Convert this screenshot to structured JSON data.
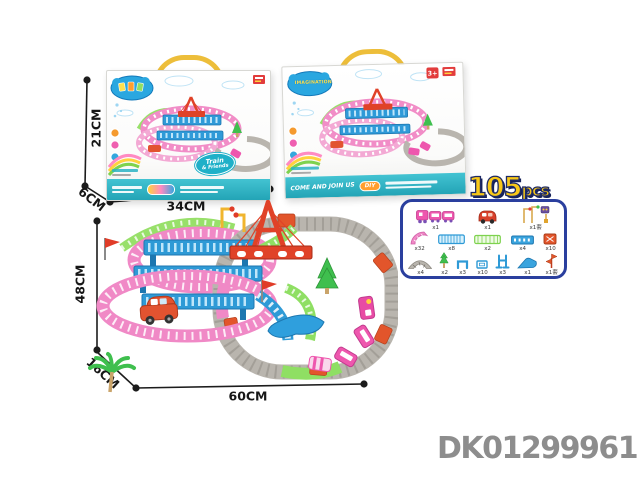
{
  "product": {
    "code": "DK01299961"
  },
  "pieces": {
    "count": "105",
    "unit": "pcs"
  },
  "dims": {
    "box_height": "21CM",
    "box_depth": "6CM",
    "box_width": "34CM",
    "set_height": "48CM",
    "set_depth": "16CM",
    "set_width": "60CM"
  },
  "box_front": {
    "badge_line1": "Train",
    "badge_line2": "& Friends"
  },
  "box_angled": {
    "logo": "IMAGINATION",
    "slogan": "COME AND JOIN US",
    "diy_label": "DIY",
    "age_label": "3+"
  },
  "parts": {
    "rows": [
      [
        {
          "name": "toy train",
          "qty": "x1"
        },
        {
          "name": "toy car",
          "qty": "x1"
        },
        {
          "name": "traffic signs set",
          "qty": "x1套"
        }
      ],
      [
        {
          "name": "pink curved track",
          "qty": "x32"
        },
        {
          "name": "blue bridge rail",
          "qty": "x8"
        },
        {
          "name": "green fence rail",
          "qty": "x2"
        },
        {
          "name": "blue straight track",
          "qty": "x4"
        },
        {
          "name": "track connector",
          "qty": "x10"
        }
      ],
      [
        {
          "name": "gray curved track",
          "qty": "x4"
        },
        {
          "name": "tree",
          "qty": "x2"
        },
        {
          "name": "u-bracket",
          "qty": "x3"
        },
        {
          "name": "base plate",
          "qty": "x10"
        },
        {
          "name": "support frame",
          "qty": "x3"
        },
        {
          "name": "slide ramp",
          "qty": "x1"
        },
        {
          "name": "windmill flag",
          "qty": "x1套"
        }
      ]
    ]
  },
  "colors": {
    "accent_pink": "#ee57ae",
    "accent_blue": "#2e9ad6",
    "accent_green": "#8fdf63",
    "accent_gray": "#b9b5ae",
    "accent_orange": "#e2552b",
    "banner_teal": "#2cb3c4",
    "pcs_yellow": "#f8c818",
    "pcs_navy": "#1e2a66",
    "code_gray": "#8d8d8d"
  }
}
